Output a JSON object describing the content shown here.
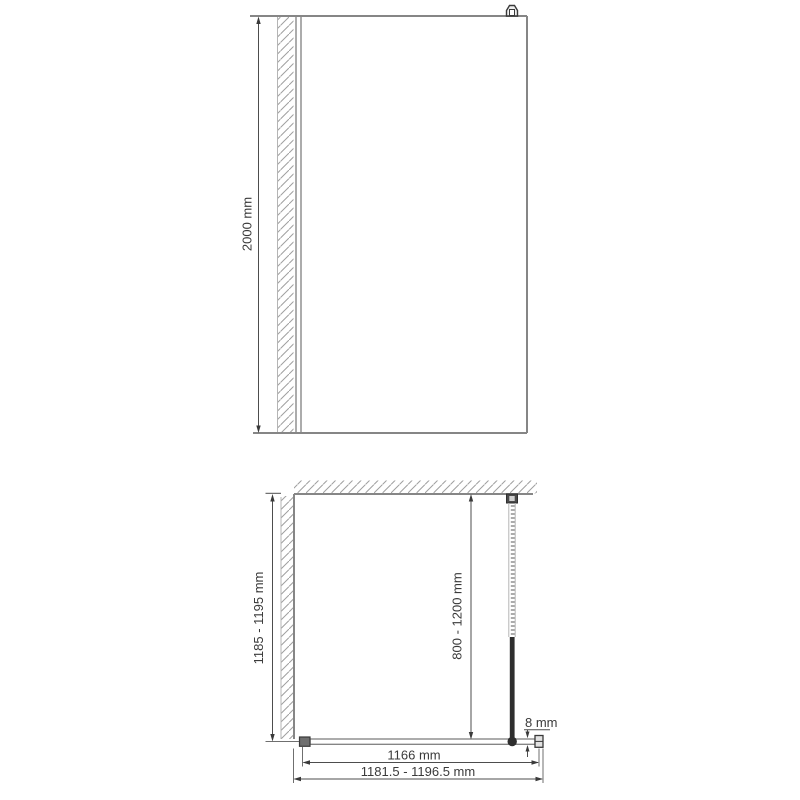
{
  "front_view": {
    "height_dim": "2000 mm"
  },
  "plan_view": {
    "depth_dim": "1185 - 1195 mm",
    "support_bar_dim": "800 - 1200 mm",
    "glass_thickness_dim": "8 mm",
    "glass_width_dim": "1166 mm",
    "overall_width_dim": "1181.5 - 1196.5 mm"
  },
  "colors": {
    "background": "#ffffff",
    "outline_gray": "#868686",
    "hatch_gray": "#9f9f9f",
    "dimension_gray": "#4d4d4d",
    "text_gray": "#3a3a3a",
    "dark_fitting": "#2e2e2e"
  }
}
